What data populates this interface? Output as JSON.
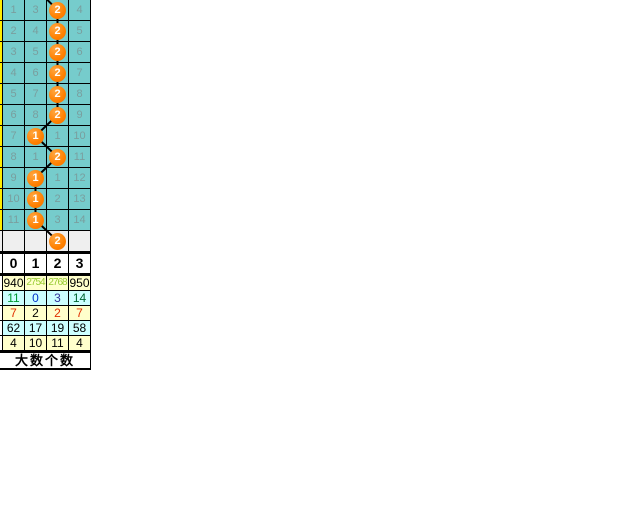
{
  "colors": {
    "teal_cell": "#76CCCC",
    "teal_text": "#7A9E9E",
    "yellow_sliver": "#FFEE00",
    "gray_row": "#EFEFEF",
    "circle_orange": "#FF8000",
    "stats_yellow": "#FFFFCC",
    "stats_cyan": "#CCFFFF",
    "grid_line": "#000000"
  },
  "trend": {
    "rows": [
      {
        "values": [
          "1",
          "3",
          null,
          "4"
        ],
        "circle_col": 2,
        "circle_value": "2",
        "gray": false
      },
      {
        "values": [
          "2",
          "4",
          null,
          "5"
        ],
        "circle_col": 2,
        "circle_value": "2",
        "gray": false
      },
      {
        "values": [
          "3",
          "5",
          null,
          "6"
        ],
        "circle_col": 2,
        "circle_value": "2",
        "gray": false
      },
      {
        "values": [
          "4",
          "6",
          null,
          "7"
        ],
        "circle_col": 2,
        "circle_value": "2",
        "gray": false
      },
      {
        "values": [
          "5",
          "7",
          null,
          "8"
        ],
        "circle_col": 2,
        "circle_value": "2",
        "gray": false
      },
      {
        "values": [
          "6",
          "8",
          null,
          "9"
        ],
        "circle_col": 2,
        "circle_value": "2",
        "gray": false
      },
      {
        "values": [
          "7",
          null,
          "1",
          "10"
        ],
        "circle_col": 1,
        "circle_value": "1",
        "gray": false
      },
      {
        "values": [
          "8",
          "1",
          null,
          "11"
        ],
        "circle_col": 2,
        "circle_value": "2",
        "gray": false
      },
      {
        "values": [
          "9",
          null,
          "1",
          "12"
        ],
        "circle_col": 1,
        "circle_value": "1",
        "gray": false
      },
      {
        "values": [
          "10",
          null,
          "2",
          "13"
        ],
        "circle_col": 1,
        "circle_value": "1",
        "gray": false
      },
      {
        "values": [
          "11",
          null,
          "3",
          "14"
        ],
        "circle_col": 1,
        "circle_value": "1",
        "gray": false
      },
      {
        "values": [
          "",
          "",
          "",
          ""
        ],
        "circle_col": 2,
        "circle_value": "2",
        "gray": true
      }
    ]
  },
  "stats": {
    "header": [
      "0",
      "1",
      "2",
      "3"
    ],
    "rows": [
      {
        "bg": "#FFFFCC",
        "values": [
          "940",
          "2754",
          "2768",
          "950"
        ],
        "colors": [
          "#000000",
          "#99CC33",
          "#99CC33",
          "#000000"
        ]
      },
      {
        "bg": "#CCFFFF",
        "values": [
          "11",
          "0",
          "3",
          "14"
        ],
        "colors": [
          "#009933",
          "#0033CC",
          "#333399",
          "#006633"
        ]
      },
      {
        "bg": "#FFFFCC",
        "values": [
          "7",
          "2",
          "2",
          "7"
        ],
        "colors": [
          "#E03000",
          "#000000",
          "#E03000",
          "#E03000"
        ]
      },
      {
        "bg": "#CCFFFF",
        "values": [
          "62",
          "17",
          "19",
          "58"
        ],
        "colors": [
          "#000000",
          "#000000",
          "#000000",
          "#000000"
        ]
      },
      {
        "bg": "#FFFFCC",
        "values": [
          "4",
          "10",
          "11",
          "4"
        ],
        "colors": [
          "#000000",
          "#000000",
          "#000000",
          "#000000"
        ]
      }
    ],
    "footer": "大数个数"
  },
  "chart_data": {
    "type": "table",
    "title": "lottery digit trend chart fragment",
    "columns": [
      "0",
      "1",
      "2",
      "3"
    ],
    "trend_rows": [
      {
        "row_no": 1,
        "miss_counts": {
          "0": 1,
          "1": 3,
          "2": "drawn",
          "3": 4
        },
        "drawn_value": 2
      },
      {
        "row_no": 2,
        "miss_counts": {
          "0": 2,
          "1": 4,
          "2": "drawn",
          "3": 5
        },
        "drawn_value": 2
      },
      {
        "row_no": 3,
        "miss_counts": {
          "0": 3,
          "1": 5,
          "2": "drawn",
          "3": 6
        },
        "drawn_value": 2
      },
      {
        "row_no": 4,
        "miss_counts": {
          "0": 4,
          "1": 6,
          "2": "drawn",
          "3": 7
        },
        "drawn_value": 2
      },
      {
        "row_no": 5,
        "miss_counts": {
          "0": 5,
          "1": 7,
          "2": "drawn",
          "3": 8
        },
        "drawn_value": 2
      },
      {
        "row_no": 6,
        "miss_counts": {
          "0": 6,
          "1": 8,
          "2": "drawn",
          "3": 9
        },
        "drawn_value": 2
      },
      {
        "row_no": 7,
        "miss_counts": {
          "0": 7,
          "1": "drawn",
          "2": 1,
          "3": 10
        },
        "drawn_value": 1
      },
      {
        "row_no": 8,
        "miss_counts": {
          "0": 8,
          "1": 1,
          "2": "drawn",
          "3": 11
        },
        "drawn_value": 2
      },
      {
        "row_no": 9,
        "miss_counts": {
          "0": 9,
          "1": "drawn",
          "2": 1,
          "3": 12
        },
        "drawn_value": 1
      },
      {
        "row_no": 10,
        "miss_counts": {
          "0": 10,
          "1": "drawn",
          "2": 2,
          "3": 13
        },
        "drawn_value": 1
      },
      {
        "row_no": 11,
        "miss_counts": {
          "0": 11,
          "1": "drawn",
          "2": 3,
          "3": 14
        },
        "drawn_value": 1
      },
      {
        "row_no": "blank",
        "drawn_value": 2
      }
    ],
    "drawn_sequence": [
      2,
      2,
      2,
      2,
      2,
      2,
      1,
      2,
      1,
      1,
      1,
      2
    ],
    "stats_matrix": {
      "columns": [
        "0",
        "1",
        "2",
        "3"
      ],
      "rows": [
        [
          940,
          2754,
          2768,
          950
        ],
        [
          11,
          0,
          3,
          14
        ],
        [
          7,
          2,
          2,
          7
        ],
        [
          62,
          17,
          19,
          58
        ],
        [
          4,
          10,
          11,
          4
        ]
      ]
    },
    "footer_label": "大数个数"
  }
}
